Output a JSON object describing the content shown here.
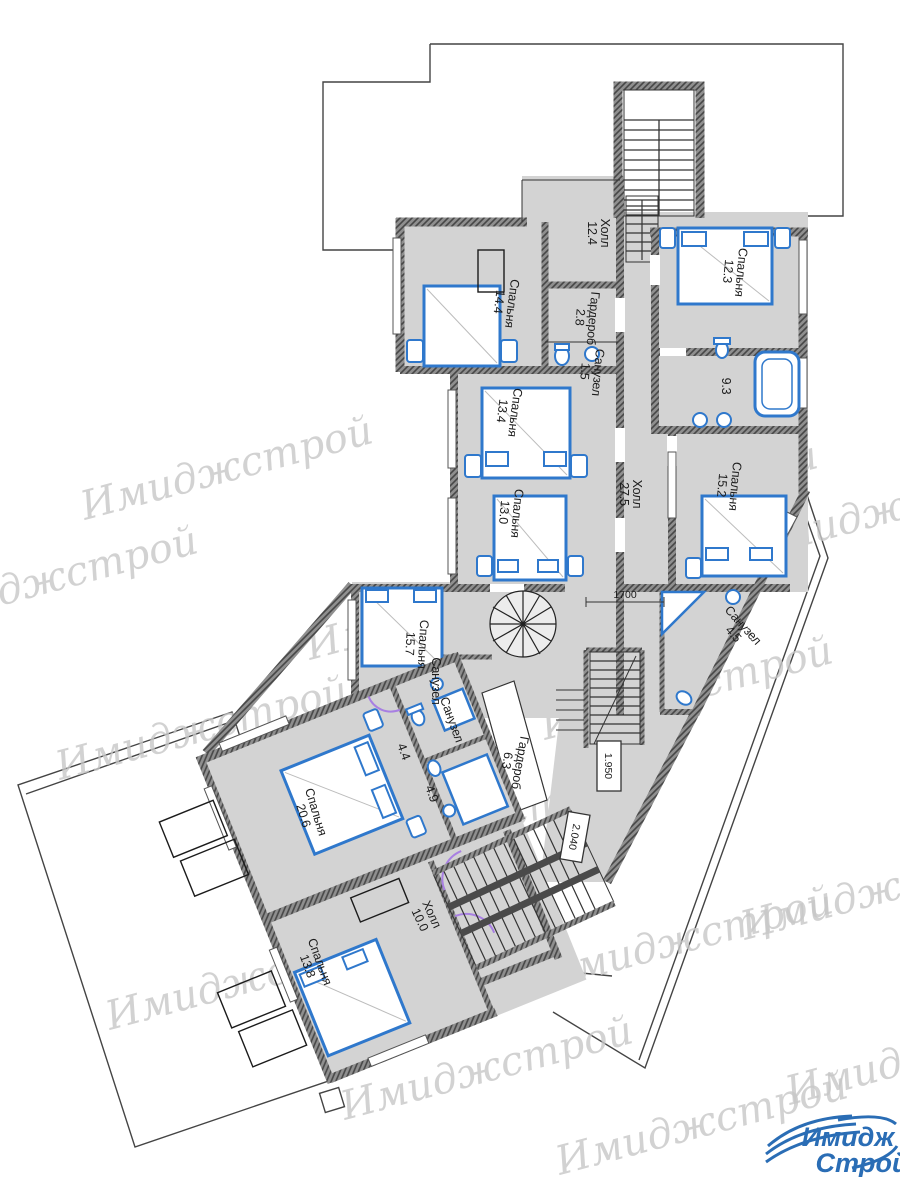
{
  "watermark": {
    "text": "Имиджстрой"
  },
  "logo": {
    "line1": "Имидж",
    "line2": "Строй"
  },
  "dimensions": {
    "d1700": "1700",
    "d1950": "1.950",
    "d2040": "2.040"
  },
  "rooms": {
    "hall_top": {
      "label": "Холл",
      "area": "12.4"
    },
    "bedroom_12_3": {
      "label": "Спальня",
      "area": "12.3"
    },
    "bedroom_14_4": {
      "label": "Спальня",
      "area": "14.4"
    },
    "wardrobe_2_8": {
      "label": "Гардероб",
      "area": "2.8"
    },
    "wc_1_5": {
      "label": "Санузел",
      "area": "1.5"
    },
    "bedroom_13_4": {
      "label": "Спальня",
      "area": "13.4"
    },
    "bath_9_3": {
      "label": "",
      "area": "9.3"
    },
    "hall_27_5": {
      "label": "Холл",
      "area": "27.5"
    },
    "bedroom_15_2": {
      "label": "Спальня",
      "area": "15.2"
    },
    "bedroom_13_0": {
      "label": "Спальня",
      "area": "13.0"
    },
    "bedroom_15_7": {
      "label": "Спальня",
      "area": "15.7"
    },
    "wc_near_15_7": {
      "label": "Санузел",
      "area": ""
    },
    "wc_4_5": {
      "label": "Санузел",
      "area": "4.5"
    },
    "wc_wing": {
      "label": "Санузел",
      "area": ""
    },
    "wc_4_4": {
      "label": "",
      "area": "4.4"
    },
    "wc_4_9": {
      "label": "",
      "area": "4.9"
    },
    "wardrobe_6_3": {
      "label": "Гардероб",
      "area": "6.3"
    },
    "bedroom_20_6": {
      "label": "Спальня",
      "area": "20.6"
    },
    "hall_10_0": {
      "label": "Холл",
      "area": "10.0"
    },
    "bedroom_13_8": {
      "label": "Спальня",
      "area": "13.8"
    }
  }
}
